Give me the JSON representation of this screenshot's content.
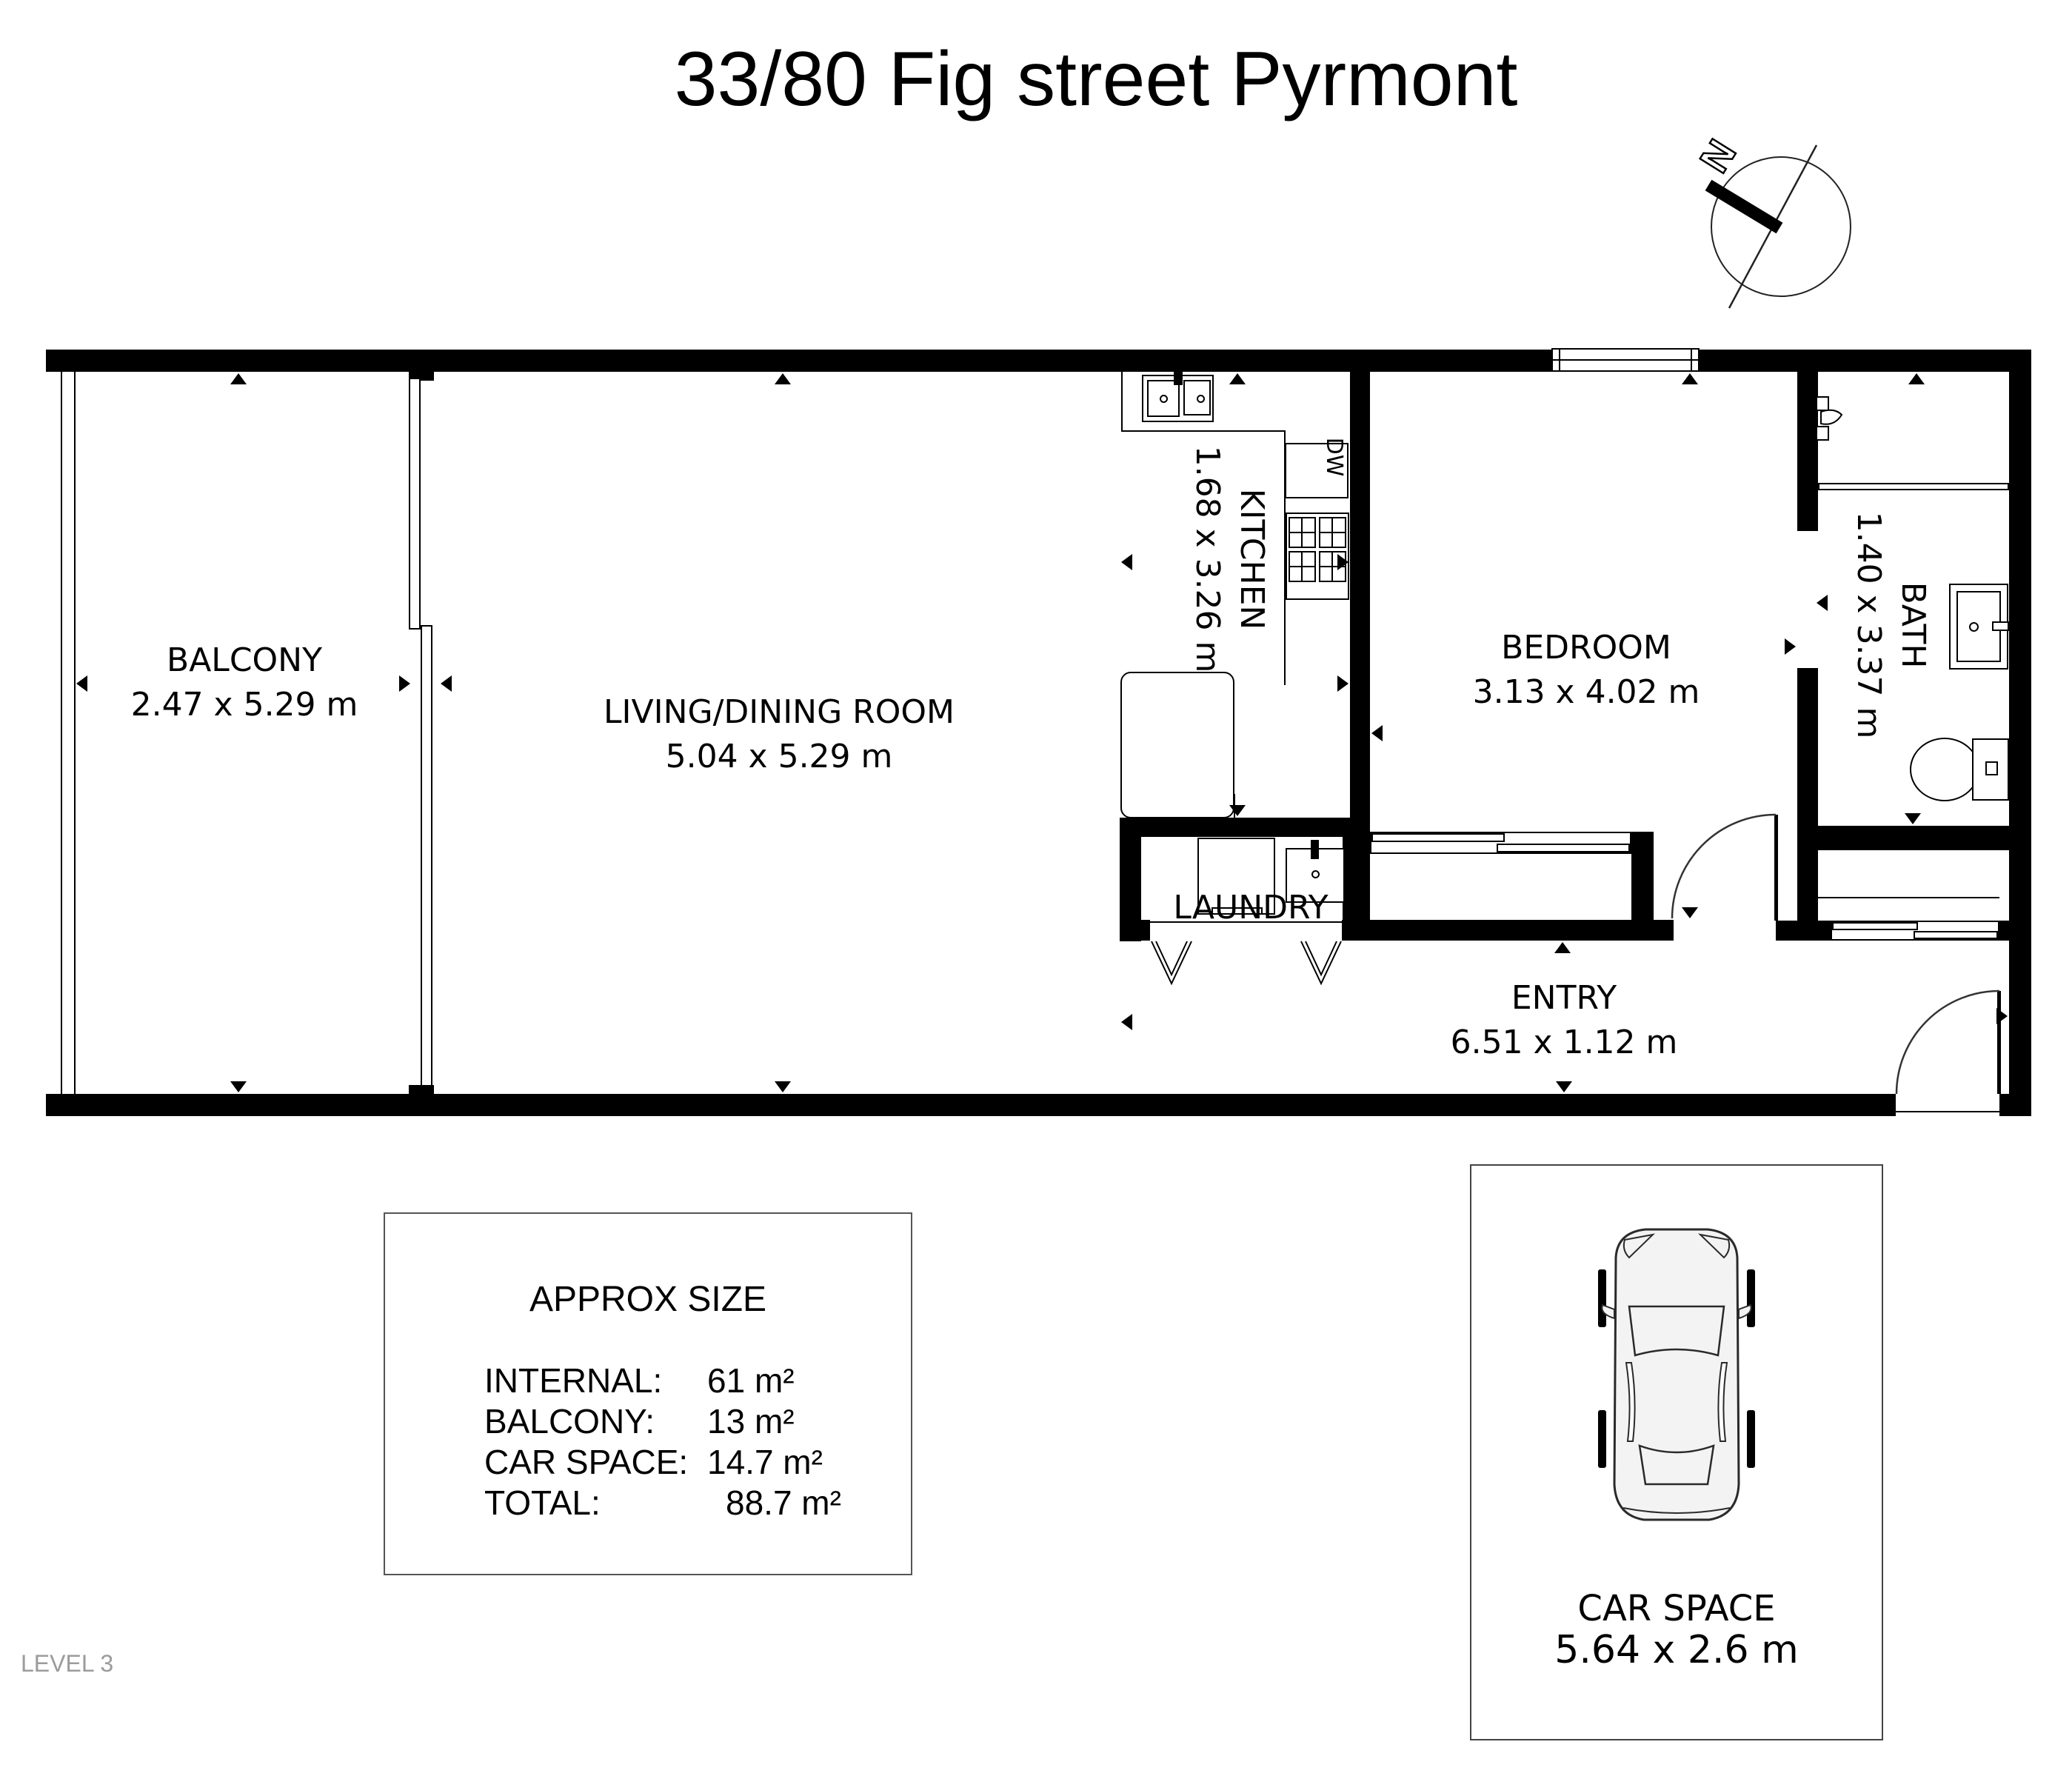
{
  "title": "33/80 Fig street Pyrmont",
  "level_label": "LEVEL 3",
  "compass": {
    "north_label": "N"
  },
  "rooms": {
    "balcony": {
      "name": "BALCONY",
      "dims": "2.47 x 5.29 m"
    },
    "living": {
      "name": "LIVING/DINING ROOM",
      "dims": "5.04 x 5.29 m"
    },
    "kitchen": {
      "name": "KITCHEN",
      "dims": "1.68 x 3.26 m"
    },
    "bedroom": {
      "name": "BEDROOM",
      "dims": "3.13 x 4.02 m"
    },
    "bath": {
      "name": "BATH",
      "dims": "1.40 x 3.37 m"
    },
    "laundry": {
      "name": "LAUNDRY"
    },
    "entry": {
      "name": "ENTRY",
      "dims": "6.51 x 1.12 m"
    }
  },
  "appliances": {
    "dishwasher_label": "DW"
  },
  "approx_size": {
    "title": "APPROX SIZE",
    "rows": [
      {
        "label": "INTERNAL:",
        "value": "61 m²"
      },
      {
        "label": "BALCONY:",
        "value": "13 m²"
      },
      {
        "label": "CAR SPACE:",
        "value": "14.7 m²"
      },
      {
        "label": "TOTAL:",
        "value": "88.7 m²"
      }
    ]
  },
  "car_space": {
    "name": "CAR SPACE",
    "dims": "5.64 x 2.6 m"
  },
  "colors": {
    "wall": "#000000",
    "level_text": "#9b9b9b",
    "car_fill": "#f3f3f3"
  }
}
